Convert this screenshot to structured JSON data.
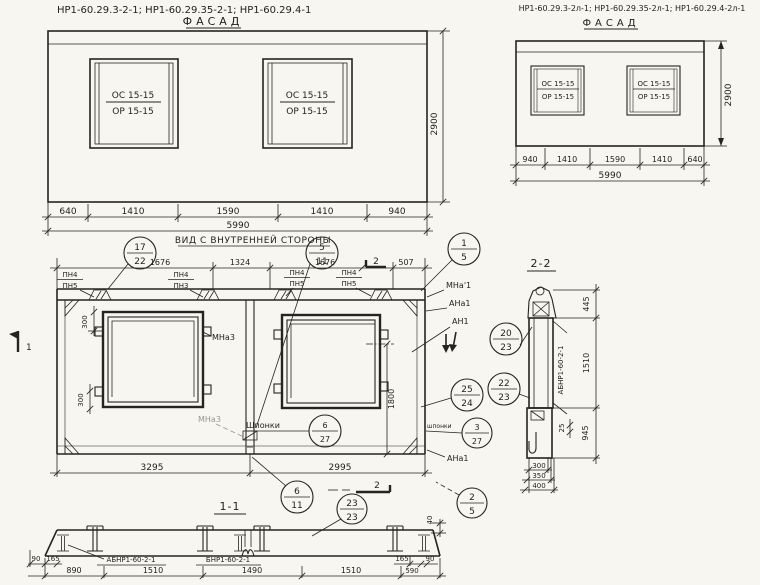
{
  "colors": {
    "paper": "#f7f6f1",
    "ink": "#26241d"
  },
  "headers": {
    "left": "НР1-60.29.3-2-1;   НР1-60.29.35-2-1;   НР1-60.29.4-1",
    "right": "НР1-60.29.3-2л-1; НР1-60.29.35-2л-1; НР1-60.29.4-2л-1"
  },
  "facade_left": {
    "title": "ФАСАД",
    "windows": [
      {
        "top": "ОС 15-15",
        "bottom": "ОР 15-15"
      },
      {
        "top": "ОС 15-15",
        "bottom": "ОР 15-15"
      }
    ],
    "dims_bottom": [
      "640",
      "1410",
      "1590",
      "1410",
      "940"
    ],
    "dim_total": "5990",
    "dim_height": "2900"
  },
  "facade_right": {
    "title": "ФАСАД",
    "windows": [
      {
        "top": "ОС 15-15",
        "bottom": "ОР 15-15"
      },
      {
        "top": "ОС 15-15",
        "bottom": "ОР 15-15"
      }
    ],
    "dims_bottom": [
      "940",
      "1410",
      "1590",
      "1410",
      "640"
    ],
    "dim_total": "5990",
    "dim_height": "2900"
  },
  "inner_view": {
    "title": "ВИД С ВНУТРЕННЕЙ СТОРОНЫ",
    "dims_top": [
      "1676",
      "1324",
      "1676",
      "507"
    ],
    "pn_labels": [
      {
        "top": "ПН4",
        "bottom": "ПН5"
      },
      {
        "top": "ПН4",
        "bottom": "ПН3"
      },
      {
        "top": "ПН4",
        "bottom": "ПН5"
      },
      {
        "top": "ПН4",
        "bottom": "ПН5"
      }
    ],
    "dim_300_top": "300",
    "dim_300_bottom": "300",
    "dim_1800": "1800",
    "dim_40": "40",
    "label_mna3": "МНа3",
    "label_mna3_faint": "МНа3",
    "label_shponki_left": "Шпонки",
    "label_shponki_right": "шпонки",
    "labels_right": [
      "МНа'1",
      "АНа1",
      "АН1",
      "АНа1"
    ],
    "dims_bottom": [
      "3295",
      "2995"
    ],
    "marker_1": "1",
    "marker_2_top": "2",
    "marker_2_bottom": "2"
  },
  "callouts": {
    "c17_22": {
      "top": "17",
      "bottom": "22"
    },
    "c5_11": {
      "top": "5",
      "bottom": "11"
    },
    "c1_5": {
      "top": "1",
      "bottom": "5"
    },
    "c20_23": {
      "top": "20",
      "bottom": "23"
    },
    "c25_24": {
      "top": "25",
      "bottom": "24"
    },
    "c22_23": {
      "top": "22",
      "bottom": "23"
    },
    "c6_27": {
      "top": "6",
      "bottom": "27"
    },
    "c3_27": {
      "top": "3",
      "bottom": "27"
    },
    "c6_11": {
      "top": "6",
      "bottom": "11"
    },
    "c23_23": {
      "top": "23",
      "bottom": "23"
    },
    "c2_5": {
      "top": "2",
      "bottom": "5"
    }
  },
  "section_1_1": {
    "title": "1-1",
    "labels": [
      "АБНР1-60-2-1",
      "БНР1-60-2-1"
    ],
    "dims_small": [
      "90",
      "165",
      "165",
      "90"
    ],
    "dims_main": [
      "890",
      "1510",
      "1490",
      "1510",
      "590"
    ]
  },
  "section_2_2": {
    "title": "2-2",
    "part_label": "АБНР1-60-2-1",
    "dims_right": [
      "445",
      "1510",
      "945"
    ],
    "dim_25": "25",
    "dims_bottom": [
      "300",
      "350",
      "400"
    ]
  }
}
